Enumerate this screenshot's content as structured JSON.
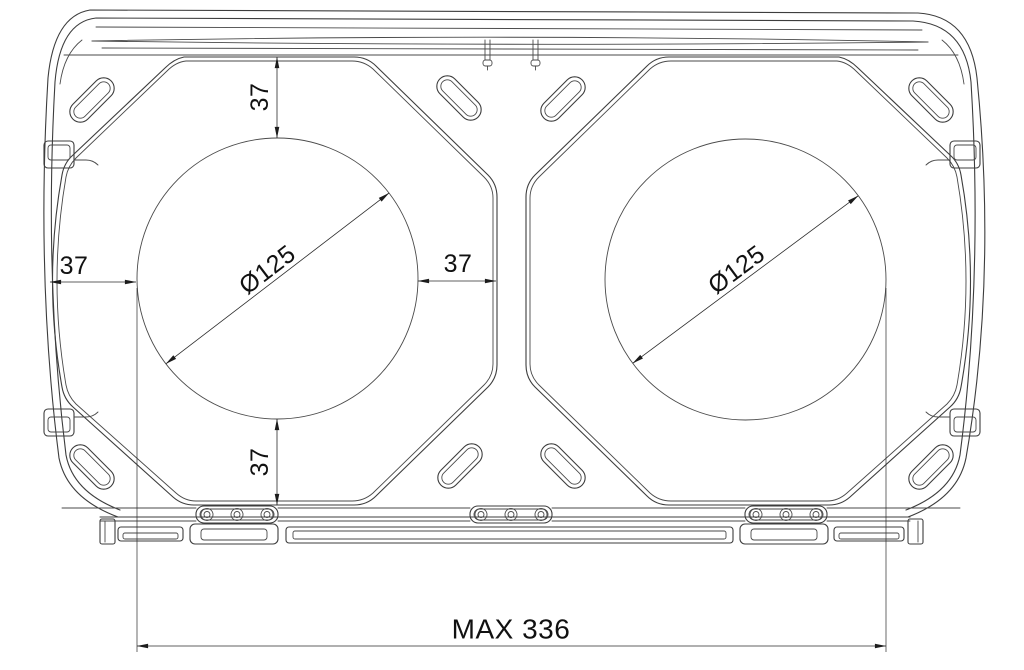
{
  "drawing": {
    "title": "dual-speaker-enclosure-mounting-dimensions",
    "background_color": "#ffffff",
    "line_color": "#3d3d3d",
    "dimension_color": "#2b2b2b",
    "dimensions": {
      "top_margin": "37",
      "bottom_margin": "37",
      "left_margin": "37",
      "center_margin": "37",
      "left_cutout_diameter": "Ø125",
      "right_cutout_diameter": "Ø125",
      "max_width": "MAX 336"
    }
  }
}
